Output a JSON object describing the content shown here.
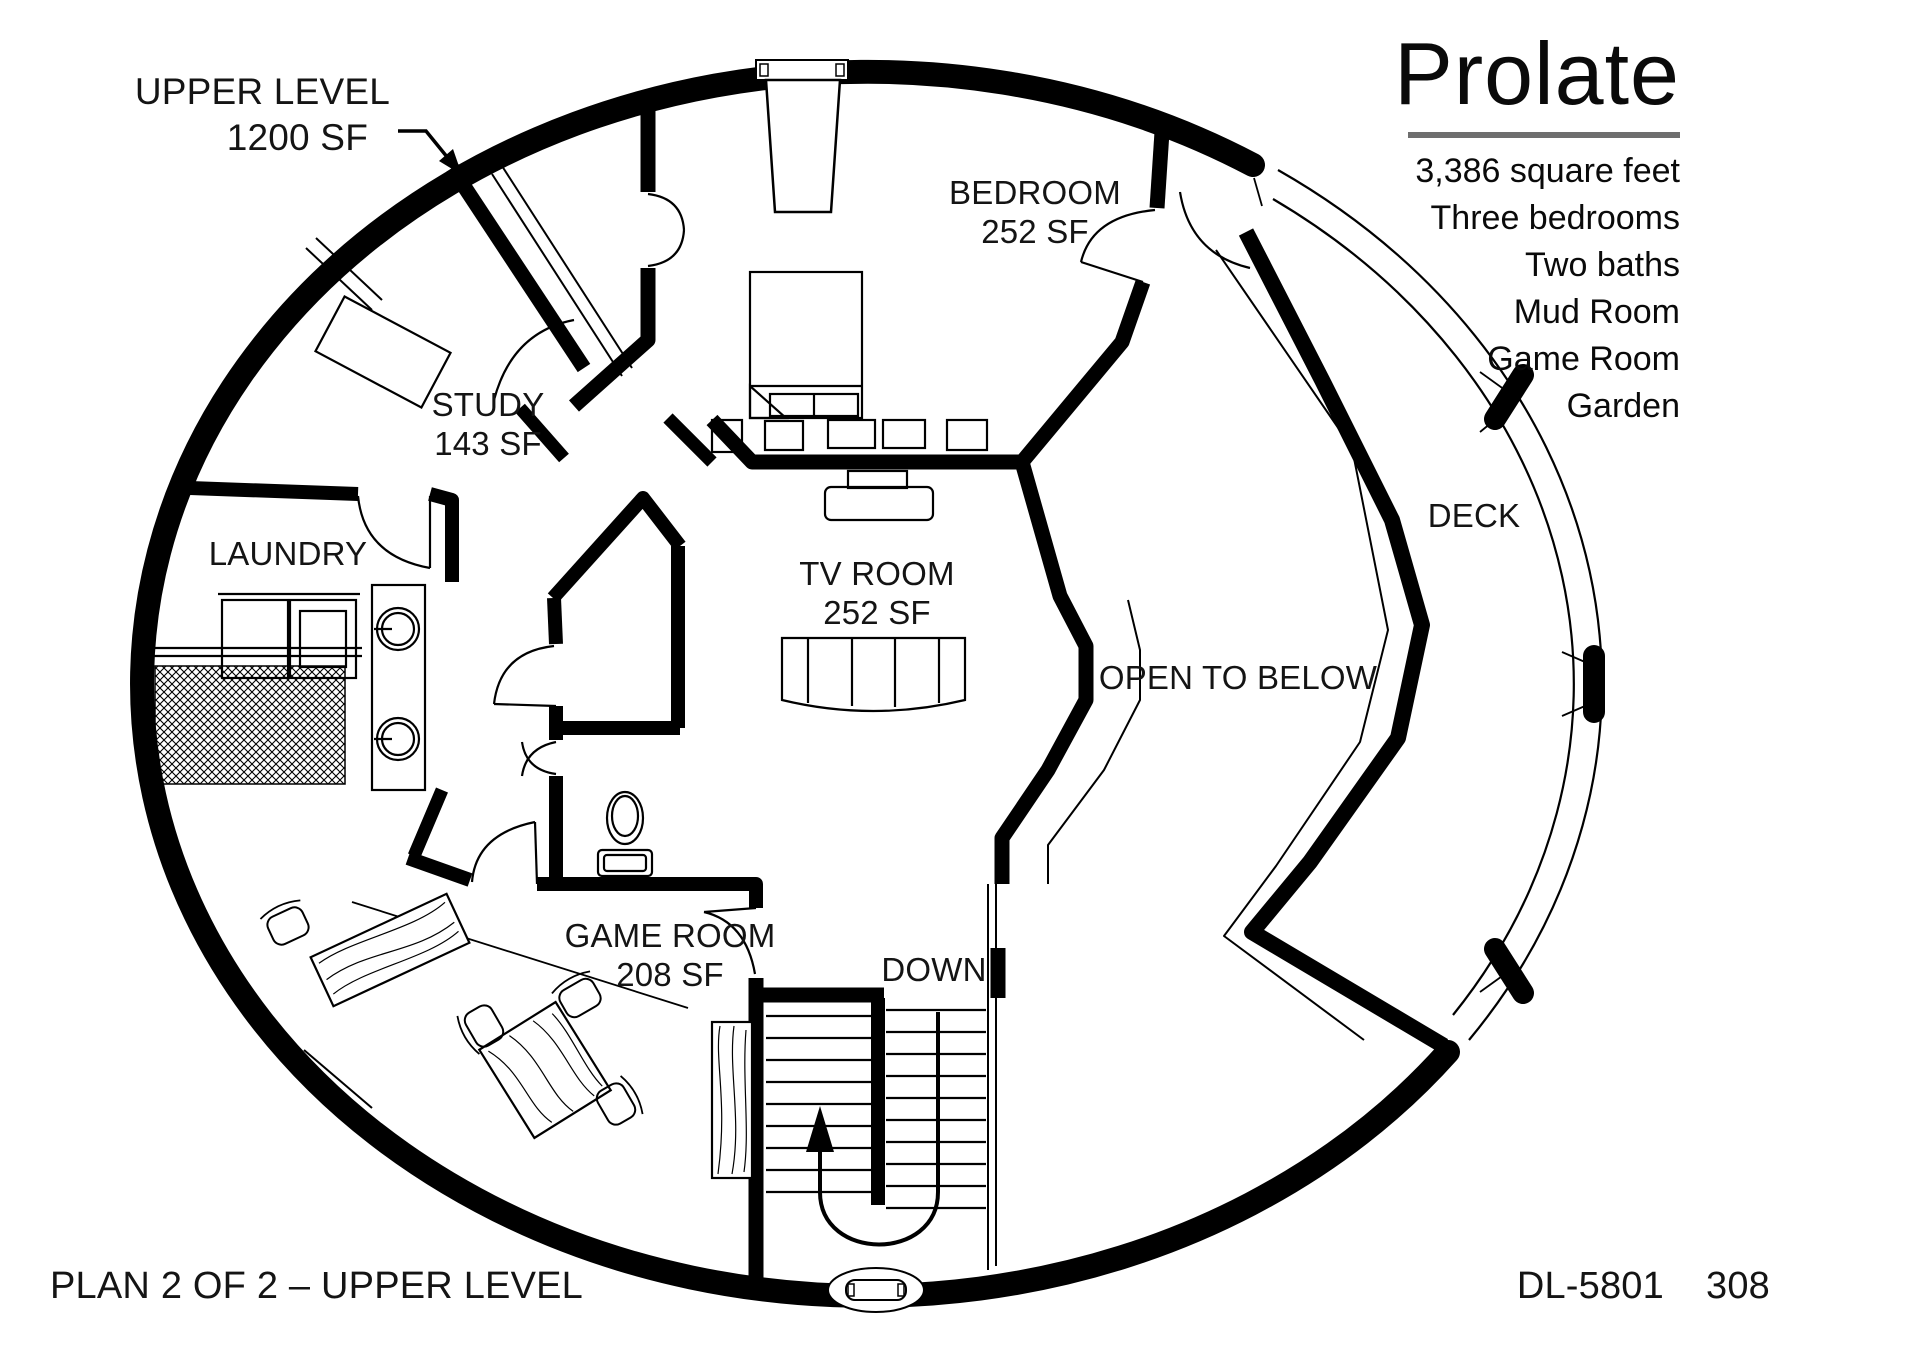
{
  "title_block": {
    "title": "Prolate",
    "details": [
      "3,386 square feet",
      "Three bedrooms",
      "Two baths",
      "Mud Room",
      "Game Room",
      "Garden"
    ]
  },
  "rooms": {
    "bedroom": {
      "name": "BEDROOM",
      "area": "252 SF"
    },
    "study": {
      "name": "STUDY",
      "area": "143 SF"
    },
    "laundry": {
      "name": "LAUNDRY"
    },
    "tv_room": {
      "name": "TV ROOM",
      "area": "252 SF"
    },
    "game_room": {
      "name": "GAME ROOM",
      "area": "208 SF"
    },
    "deck": {
      "name": "DECK"
    },
    "open_to_below": {
      "name": "OPEN TO BELOW"
    },
    "stairs": {
      "name": "DOWN"
    }
  },
  "annotations": {
    "pointer_label_line1": "UPPER LEVEL",
    "pointer_label_line2": "1200 SF",
    "plan_label": "PLAN 2 OF 2 – UPPER LEVEL",
    "plan_number": "DL-5801",
    "page_number": "308"
  },
  "colors": {
    "wall": "#000000",
    "background": "#ffffff",
    "rule": "#6e6e6e",
    "text": "#141414"
  }
}
